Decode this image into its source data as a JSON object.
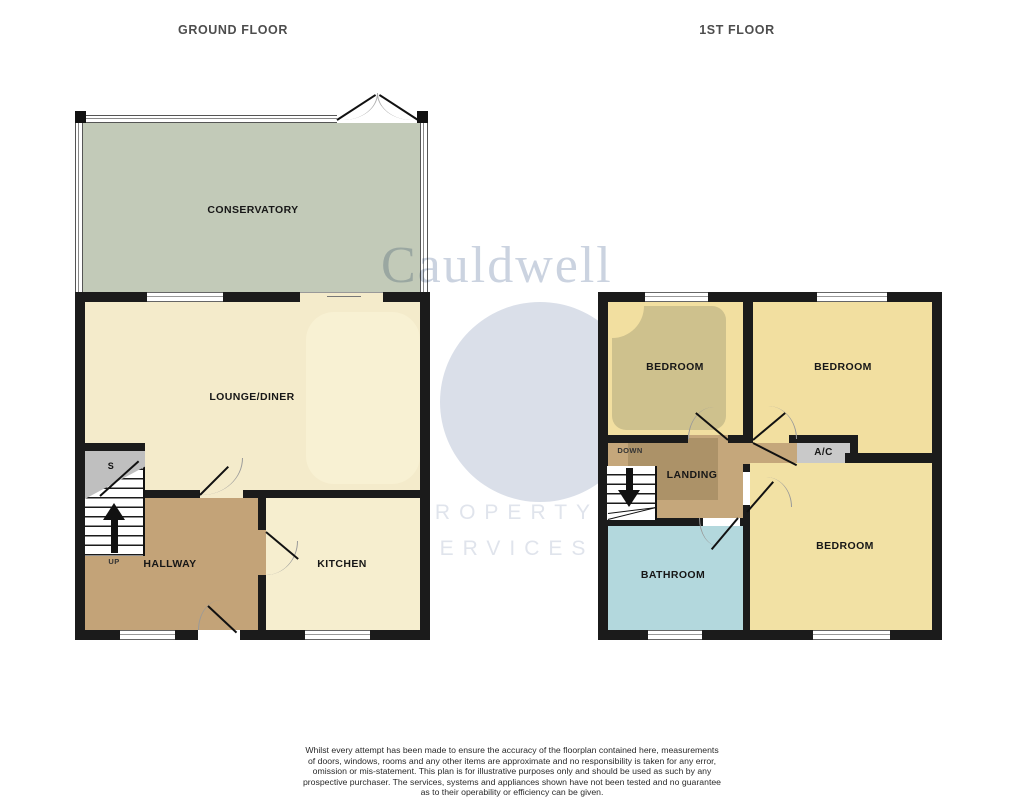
{
  "titles": {
    "ground": "GROUND FLOOR",
    "first": "1ST FLOOR"
  },
  "ground_floor": {
    "rooms": [
      {
        "name": "conservatory",
        "label": "CONSERVATORY"
      },
      {
        "name": "lounge-diner",
        "label": "LOUNGE/DINER"
      },
      {
        "name": "hallway",
        "label": "HALLWAY"
      },
      {
        "name": "kitchen",
        "label": "KITCHEN"
      }
    ],
    "stairs": {
      "direction": "UP",
      "storage": "S"
    }
  },
  "first_floor": {
    "rooms": [
      {
        "name": "bedroom-front-left",
        "label": "BEDROOM"
      },
      {
        "name": "bedroom-front-right",
        "label": "BEDROOM"
      },
      {
        "name": "landing",
        "label": "LANDING"
      },
      {
        "name": "airing-cupboard",
        "label": "A/C"
      },
      {
        "name": "bathroom",
        "label": "BATHROOM"
      },
      {
        "name": "bedroom-rear",
        "label": "BEDROOM"
      }
    ],
    "stairs": {
      "direction": "DOWN"
    }
  },
  "watermark": {
    "brand": "Cauldwell",
    "line1": "PROPERTY",
    "line2": "SERVICES"
  },
  "footer": {
    "disclaimer_lines": [
      "Whilst every attempt has been made to ensure the accuracy of the floorplan contained here, measurements",
      "of doors, windows, rooms and any other items are approximate and no responsibility is taken for any error,",
      "omission or mis-statement. This plan is for illustrative purposes only and should be used as such by any",
      "prospective purchaser. The services, systems and appliances shown have not been tested and no guarantee",
      "as to their operability or efficiency can be given."
    ],
    "made_with": "Made with Metropix ©2025"
  },
  "colors": {
    "wall": "#1b1b1b",
    "conservatory_green": "#C2CAB8",
    "cream": "#F4EBCB",
    "hallway_tan": "#C3A378",
    "landing_tan": "#C5A77B",
    "landing_shade": "#AC9268",
    "bedroom_yellow": "#F2DFA0",
    "bedroom_shade_olive": "#CEC18D",
    "bathroom_blue": "#B3D8DD",
    "ac_gray": "#C9C9C9",
    "watermark_blue_gray": "#DADFE9",
    "title_gray": "#4d4d4d"
  }
}
